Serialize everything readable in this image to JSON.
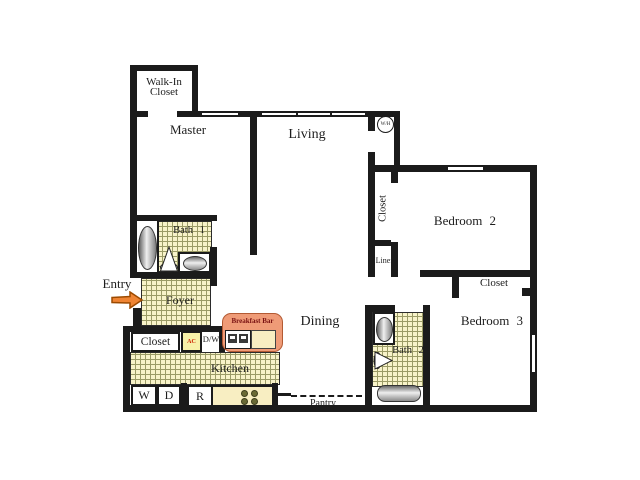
{
  "rooms": {
    "master": "Master",
    "living": "Living",
    "dining": "Dining",
    "kitchen": "Kitchen",
    "foyer": "Foyer",
    "bedroom2": "Bedroom 2",
    "bedroom3": "Bedroom 3",
    "bath1": "Bath 1",
    "bath2": "Bath 2"
  },
  "closets": {
    "walk_in_line1": "Walk-In",
    "walk_in_line2": "Closet",
    "bedroom2_closet": "Closet",
    "bedroom3_closet": "Closet",
    "entry_closet": "Closet",
    "linen": "Linen",
    "pantry": "Pantry"
  },
  "fixtures": {
    "water_heater": "W/H",
    "ac_unit": "AC",
    "dishwasher": "D/W",
    "washer": "W",
    "dryer": "D",
    "refrigerator": "R",
    "breakfast_bar": "Breakfast Bar"
  },
  "entry": {
    "label": "Entry"
  },
  "colors": {
    "wall": "#1b1b1b",
    "tile_fill": "#f8f3c9",
    "tile_grid": "#9b9b66",
    "counter_fill": "#f8eec2",
    "breakfast_bar_fill": "#ef9b77",
    "breakfast_bar_border": "#b35a33",
    "breakfast_bar_text": "#7a1212",
    "entry_arrow_fill": "#ef8433",
    "entry_arrow_border": "#9c4a00",
    "ac_fill": "#f7f1a8",
    "ac_text": "#cc2200"
  }
}
